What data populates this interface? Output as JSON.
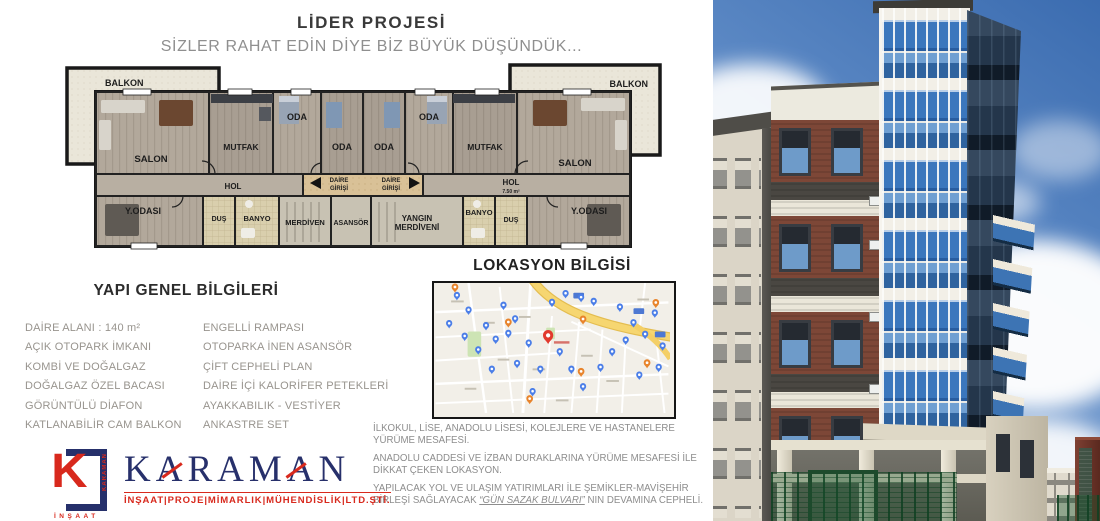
{
  "header": {
    "title": "LİDER PROJESİ",
    "subtitle": "SİZLER RAHAT EDİN DİYE BİZ BÜYÜK DÜŞÜNDÜK..."
  },
  "floor_plan": {
    "balkon_left": "BALKON",
    "balkon_right": "BALKON",
    "salon_left": "SALON",
    "salon_right": "SALON",
    "mutfak_left": "MUTFAK",
    "mutfak_right": "MUTFAK",
    "oda_left_1": "ODA",
    "oda_left_2": "ODA",
    "oda_right_1": "ODA",
    "oda_right_2": "ODA",
    "hol_left": "HOL",
    "hol_right": "HOL",
    "hol_right_area": "7.50 m²",
    "daire_girisi_line1": "DAİRE",
    "daire_girisi_line2": "GİRİŞİ",
    "yodasi_left": "Y.ODASI",
    "yodasi_right": "Y.ODASI",
    "dus_left": "DUŞ",
    "dus_right": "DUŞ",
    "banyo_left": "BANYO",
    "banyo_right": "BANYO",
    "merdiven": "MERDİVEN",
    "asansor": "ASANSÖR",
    "yangin_line1": "YANGIN",
    "yangin_line2": "MERDİVENİ"
  },
  "general_info": {
    "heading": "YAPI GENEL BİLGİLERİ",
    "left_items": [
      "DAİRE ALANI : 140 m²",
      "AÇIK OTOPARK İMKANI",
      "KOMBİ VE DOĞALGAZ",
      "DOĞALGAZ ÖZEL BACASI",
      "GÖRÜNTÜLÜ DİAFON",
      "KATLANABİLİR CAM BALKON"
    ],
    "right_items": [
      "ENGELLİ RAMPASI",
      "OTOPARKA İNEN ASANSÖR",
      "ÇİFT CEPHELİ PLAN",
      "DAİRE İÇİ KALORİFER PETEKLERİ",
      "AYAKKABILIK - VESTİYER",
      "ANKASTRE SET"
    ]
  },
  "location": {
    "heading": "LOKASYON BİLGİSİ"
  },
  "paragraphs": {
    "p1": "İLKOKUL, LİSE, ANADOLU LİSESİ, KOLEJLERE VE HASTANELERE YÜRÜME MESAFESİ.",
    "p2": "ANADOLU CADDESİ VE İZBAN DURAKLARINA YÜRÜME MESAFESİ İLE DİKKAT ÇEKEN LOKASYON.",
    "p3_before": "YAPILACAK  YOL VE ULAŞIM YATIRIMLARI İLE ŞEMİKLER-MAVİŞEHİR BİRLEŞİ SAĞLAYACAK  ",
    "p3_emphasis": "“GÜN SAZAK BULVARI”",
    "p3_after": " NIN DEVAMINA CEPHELİ."
  },
  "logo": {
    "brand": "KARAMAN",
    "mark_letter": "K",
    "mark_bottom": "İNŞAAT",
    "tagline": "İNŞAAT|PROJE|MİMARLIK|MÜHENDİSLİK|LTD.ŞTİ.",
    "navy": "#26306b",
    "red": "#d8291d"
  },
  "map": {
    "blue_pin_color": "#4b7ee8",
    "orange_pin_color": "#e8842c",
    "main_pin_color": "#e23a2e",
    "road_yellow": "#f4cf66",
    "main_pin": [
      116,
      63
    ],
    "blue_pins": [
      [
        14,
        47
      ],
      [
        22,
        18
      ],
      [
        34,
        33
      ],
      [
        30,
        60
      ],
      [
        44,
        74
      ],
      [
        52,
        49
      ],
      [
        58,
        94
      ],
      [
        62,
        63
      ],
      [
        70,
        28
      ],
      [
        75,
        57
      ],
      [
        82,
        42
      ],
      [
        84,
        88
      ],
      [
        96,
        67
      ],
      [
        100,
        117
      ],
      [
        108,
        94
      ],
      [
        120,
        25
      ],
      [
        128,
        76
      ],
      [
        134,
        16
      ],
      [
        140,
        94
      ],
      [
        150,
        20
      ],
      [
        152,
        112
      ],
      [
        163,
        24
      ],
      [
        170,
        92
      ],
      [
        182,
        76
      ],
      [
        190,
        30
      ],
      [
        196,
        64
      ],
      [
        204,
        46
      ],
      [
        210,
        100
      ],
      [
        216,
        58
      ],
      [
        226,
        36
      ],
      [
        230,
        92
      ],
      [
        234,
        70
      ]
    ],
    "orange_pins": [
      [
        20,
        10
      ],
      [
        75,
        46
      ],
      [
        152,
        43
      ],
      [
        227,
        26
      ],
      [
        150,
        97
      ],
      [
        97,
        125
      ],
      [
        218,
        88
      ]
    ]
  }
}
